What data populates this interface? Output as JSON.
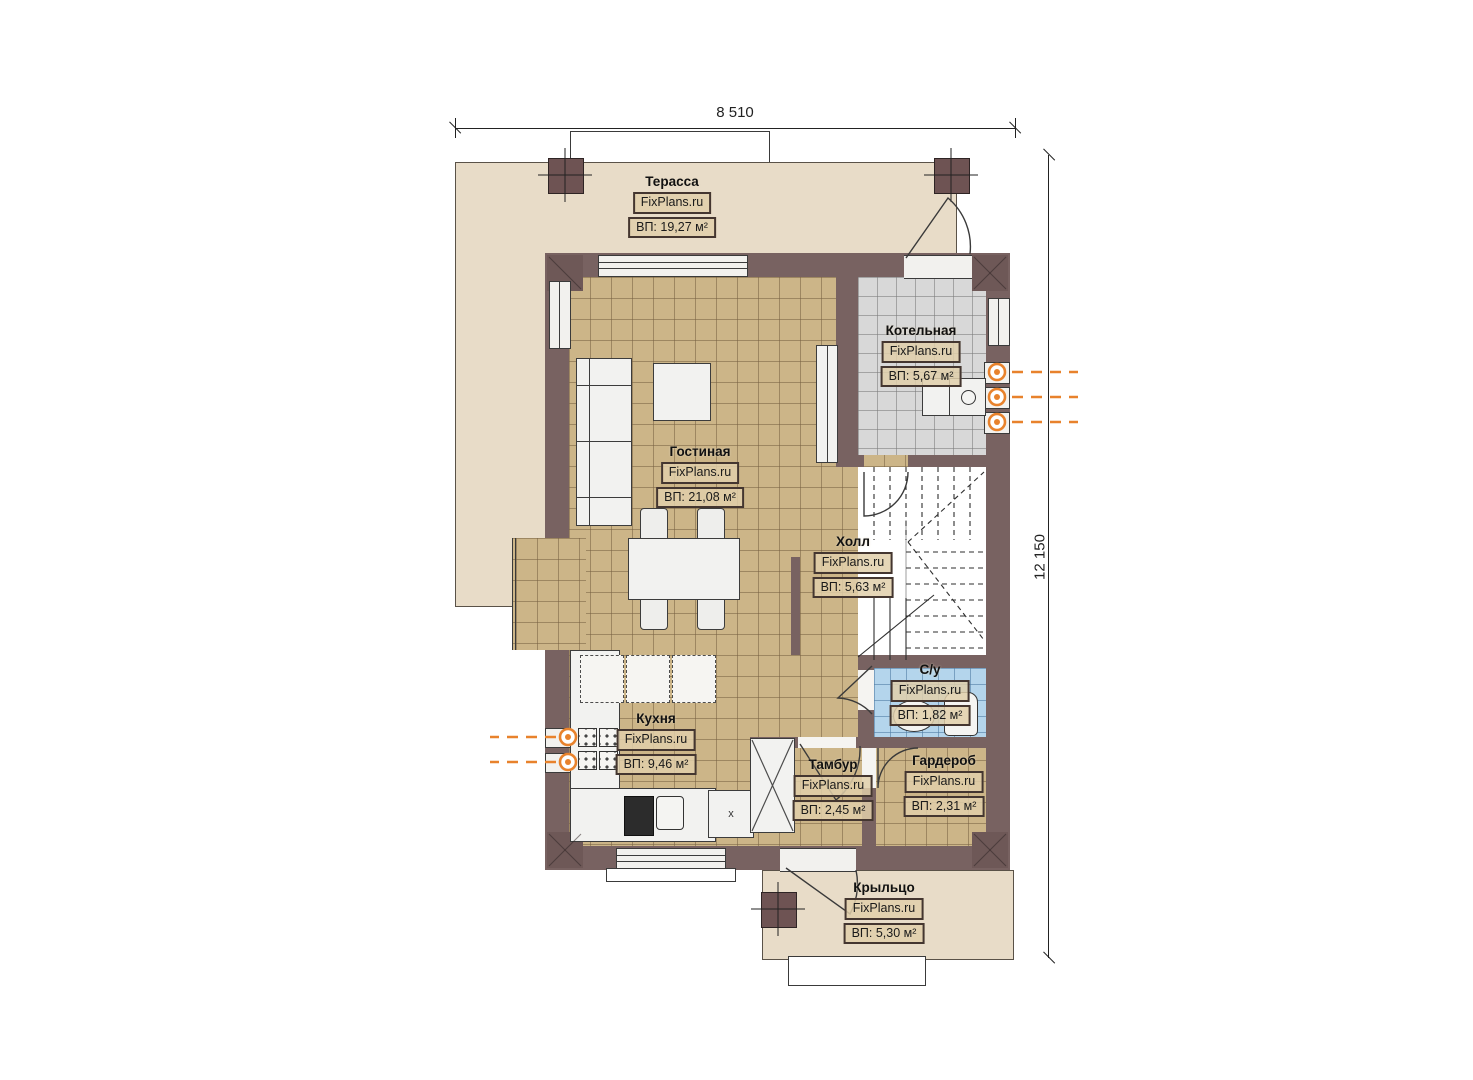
{
  "plan": {
    "type": "floor-plan",
    "branding": "FixPlans.ru",
    "dimensions": {
      "width_label": "8 510",
      "height_label": "12 150"
    },
    "rooms": [
      {
        "name": "Терасса",
        "site": "FixPlans.ru",
        "area": "ВП: 19,27 м²"
      },
      {
        "name": "Котельная",
        "site": "FixPlans.ru",
        "area": "ВП: 5,67 м²"
      },
      {
        "name": "Гостиная",
        "site": "FixPlans.ru",
        "area": "ВП: 21,08 м²"
      },
      {
        "name": "Холл",
        "site": "FixPlans.ru",
        "area": "ВП: 5,63 м²"
      },
      {
        "name": "С/у",
        "site": "FixPlans.ru",
        "area": "ВП: 1,82 м²"
      },
      {
        "name": "Кухня",
        "site": "FixPlans.ru",
        "area": "ВП: 9,46 м²"
      },
      {
        "name": "Тамбур",
        "site": "FixPlans.ru",
        "area": "ВП: 2,45 м²"
      },
      {
        "name": "Гардероб",
        "site": "FixPlans.ru",
        "area": "ВП: 2,31 м²"
      },
      {
        "name": "Крыльцо",
        "site": "FixPlans.ru",
        "area": "ВП: 5,30 м²"
      }
    ],
    "annotations": {
      "cabinet_mark": "x"
    },
    "colors": {
      "wall": "#786261",
      "terrace": "#e8dcc8",
      "floor_tan": "#ccb588",
      "floor_gray": "#d8d8d8",
      "floor_blue": "#b4d5ec",
      "utility_orange": "#e8822c"
    }
  }
}
